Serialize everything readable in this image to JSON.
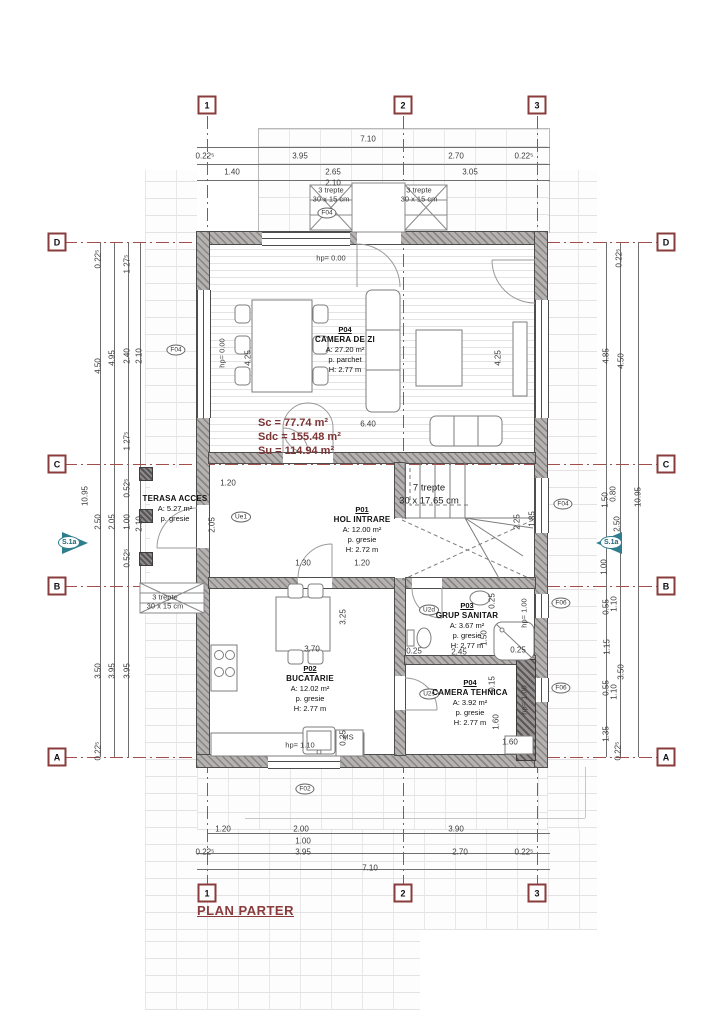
{
  "title": "PLAN PARTER",
  "area_summary": {
    "sc": "Sc = 77.74 m²",
    "sdc": "Sdc = 155.48 m²",
    "su": "Su = 114.94 m²"
  },
  "section_marker": {
    "label": "S.1a"
  },
  "colors": {
    "axis": "#9a4545",
    "section_marker": "#2e7e8e",
    "title": "#8a3b3b",
    "summary": "#7c3434",
    "wall_fill": "#b6b2b2"
  },
  "terasa": {
    "name": "TERASA ACCES",
    "area": "A: 5.27 m²",
    "floor": "p. gresie"
  },
  "rooms": [
    {
      "num": "P04",
      "name": "CAMERA DE ZI",
      "l1": "A: 27.20 m²",
      "l2": "p. parchet",
      "l3": "H: 2.77 m",
      "x": 345,
      "y": 325
    },
    {
      "num": "P01",
      "name": "HOL INTRARE",
      "l1": "A: 12.00 m²",
      "l2": "p. gresie",
      "l3": "H: 2.72 m",
      "x": 362,
      "y": 505
    },
    {
      "num": "P02",
      "name": "BUCATARIE",
      "l1": "A: 12.02 m²",
      "l2": "p. gresie",
      "l3": "H: 2.77 m",
      "x": 310,
      "y": 664
    },
    {
      "num": "P03",
      "name": "GRUP SANITAR",
      "l1": "A: 3.67 m²",
      "l2": "p. gresie",
      "l3": "H: 2.77 m",
      "x": 467,
      "y": 601
    },
    {
      "num": "P04",
      "name": "CAMERA TEHNICA",
      "l1": "A: 3.92 m²",
      "l2": "p. gresie",
      "l3": "H: 2.77 m",
      "x": 470,
      "y": 678
    }
  ],
  "axis_markers": [
    {
      "t": "1",
      "x": 207,
      "y": 105
    },
    {
      "t": "2",
      "x": 403,
      "y": 105
    },
    {
      "t": "3",
      "x": 537,
      "y": 105
    },
    {
      "t": "1",
      "x": 207,
      "y": 893
    },
    {
      "t": "2",
      "x": 403,
      "y": 893
    },
    {
      "t": "3",
      "x": 537,
      "y": 893
    },
    {
      "t": "D",
      "x": 57,
      "y": 242
    },
    {
      "t": "C",
      "x": 57,
      "y": 464
    },
    {
      "t": "B",
      "x": 57,
      "y": 586
    },
    {
      "t": "A",
      "x": 57,
      "y": 757
    },
    {
      "t": "D",
      "x": 666,
      "y": 242
    },
    {
      "t": "C",
      "x": 666,
      "y": 464
    },
    {
      "t": "B",
      "x": 666,
      "y": 586
    },
    {
      "t": "A",
      "x": 666,
      "y": 757
    }
  ],
  "tags": [
    {
      "t": "F04",
      "x": 327,
      "y": 213
    },
    {
      "t": "F04",
      "x": 176,
      "y": 350
    },
    {
      "t": "F04",
      "x": 563,
      "y": 504
    },
    {
      "t": "F06",
      "x": 561,
      "y": 603
    },
    {
      "t": "F06",
      "x": 561,
      "y": 688
    },
    {
      "t": "F02",
      "x": 305,
      "y": 789
    },
    {
      "t": "U2d",
      "x": 429,
      "y": 610
    },
    {
      "t": "U2s",
      "x": 429,
      "y": 694
    },
    {
      "t": "Ue1",
      "x": 241,
      "y": 517
    }
  ],
  "dimension_labels": [
    {
      "t": "7.10",
      "x": 368,
      "y": 139
    },
    {
      "t": "0.22⁵",
      "x": 205,
      "y": 156
    },
    {
      "t": "3.95",
      "x": 300,
      "y": 156
    },
    {
      "t": "2.70",
      "x": 456,
      "y": 156
    },
    {
      "t": "0.22⁵",
      "x": 524,
      "y": 156
    },
    {
      "t": "1.40",
      "x": 232,
      "y": 172
    },
    {
      "t": "2.65",
      "x": 333,
      "y": 172
    },
    {
      "t": "3.05",
      "x": 470,
      "y": 172
    },
    {
      "t": "2.10",
      "x": 333,
      "y": 183
    },
    {
      "t": "1.20",
      "x": 223,
      "y": 829
    },
    {
      "t": "2.00",
      "x": 301,
      "y": 829
    },
    {
      "t": "3.90",
      "x": 456,
      "y": 829
    },
    {
      "t": "1.00",
      "x": 303,
      "y": 841
    },
    {
      "t": "0.22⁵",
      "x": 205,
      "y": 852
    },
    {
      "t": "3.95",
      "x": 303,
      "y": 852
    },
    {
      "t": "2.70",
      "x": 460,
      "y": 852
    },
    {
      "t": "0.22⁵",
      "x": 524,
      "y": 852
    },
    {
      "t": "7.10",
      "x": 370,
      "y": 868
    },
    {
      "t": "0.22⁵",
      "x": 98,
      "y": 259,
      "r": -90
    },
    {
      "t": "1.27⁵",
      "x": 127,
      "y": 264,
      "r": -90
    },
    {
      "t": "4.50",
      "x": 98,
      "y": 366,
      "r": -90
    },
    {
      "t": "4.95",
      "x": 112,
      "y": 358,
      "r": -90
    },
    {
      "t": "2.40",
      "x": 127,
      "y": 356,
      "r": -90
    },
    {
      "t": "2.10",
      "x": 139,
      "y": 356,
      "r": -90
    },
    {
      "t": "1.27⁵",
      "x": 127,
      "y": 441,
      "r": -90
    },
    {
      "t": "10.95",
      "x": 85,
      "y": 496,
      "r": -90
    },
    {
      "t": "2.50",
      "x": 98,
      "y": 522,
      "r": -90
    },
    {
      "t": "2.05",
      "x": 112,
      "y": 522,
      "r": -90
    },
    {
      "t": "0.52⁵",
      "x": 127,
      "y": 488,
      "r": -90
    },
    {
      "t": "1.00",
      "x": 127,
      "y": 522,
      "r": -90
    },
    {
      "t": "2.10",
      "x": 139,
      "y": 524,
      "r": -90
    },
    {
      "t": "0.52⁵",
      "x": 127,
      "y": 558,
      "r": -90
    },
    {
      "t": "3.50",
      "x": 98,
      "y": 671,
      "r": -90
    },
    {
      "t": "3.95",
      "x": 112,
      "y": 671,
      "r": -90
    },
    {
      "t": "3.95",
      "x": 127,
      "y": 671,
      "r": -90
    },
    {
      "t": "0.22⁵",
      "x": 98,
      "y": 751,
      "r": -90
    },
    {
      "t": "0.22⁵",
      "x": 619,
      "y": 258,
      "r": -90
    },
    {
      "t": "4.85",
      "x": 606,
      "y": 356,
      "r": -90
    },
    {
      "t": "4.50",
      "x": 621,
      "y": 361,
      "r": -90
    },
    {
      "t": "10.95",
      "x": 638,
      "y": 497,
      "r": -90
    },
    {
      "t": "1.50",
      "x": 605,
      "y": 500,
      "r": -90
    },
    {
      "t": "0.80",
      "x": 613,
      "y": 494,
      "r": -90
    },
    {
      "t": "2.50",
      "x": 617,
      "y": 524,
      "r": -90
    },
    {
      "t": "1.00",
      "x": 604,
      "y": 567,
      "r": -90
    },
    {
      "t": "0.55",
      "x": 606,
      "y": 607,
      "r": -90
    },
    {
      "t": "1.10",
      "x": 614,
      "y": 604,
      "r": -90
    },
    {
      "t": "1.15",
      "x": 607,
      "y": 647,
      "r": -90
    },
    {
      "t": "3.50",
      "x": 621,
      "y": 672,
      "r": -90
    },
    {
      "t": "0.55",
      "x": 606,
      "y": 688,
      "r": -90
    },
    {
      "t": "1.10",
      "x": 614,
      "y": 692,
      "r": -90
    },
    {
      "t": "1.35",
      "x": 606,
      "y": 734,
      "r": -90
    },
    {
      "t": "0.22⁵",
      "x": 618,
      "y": 751,
      "r": -90
    },
    {
      "t": "6.40",
      "x": 368,
      "y": 424
    },
    {
      "t": "4.25",
      "x": 248,
      "y": 358,
      "r": -90
    },
    {
      "t": "4.25",
      "x": 498,
      "y": 358,
      "r": -90
    },
    {
      "t": "1.20",
      "x": 228,
      "y": 483
    },
    {
      "t": "2.05",
      "x": 212,
      "y": 525,
      "r": -90
    },
    {
      "t": "1.30",
      "x": 303,
      "y": 563
    },
    {
      "t": "1.20",
      "x": 362,
      "y": 563
    },
    {
      "t": "2.25",
      "x": 517,
      "y": 522,
      "r": -90
    },
    {
      "t": "1.85",
      "x": 532,
      "y": 519,
      "r": -90
    },
    {
      "t": "3.70",
      "x": 312,
      "y": 649
    },
    {
      "t": "3.25",
      "x": 343,
      "y": 617,
      "r": -90
    },
    {
      "t": "0.25",
      "x": 343,
      "y": 738,
      "r": -90
    },
    {
      "t": "0.25",
      "x": 414,
      "y": 651
    },
    {
      "t": "2.45",
      "x": 459,
      "y": 652
    },
    {
      "t": "1.50",
      "x": 484,
      "y": 638,
      "r": -90
    },
    {
      "t": "0.25",
      "x": 518,
      "y": 650
    },
    {
      "t": "0.25",
      "x": 492,
      "y": 601,
      "r": -90
    },
    {
      "t": "1.60",
      "x": 496,
      "y": 722,
      "r": -90
    },
    {
      "t": "0.15",
      "x": 492,
      "y": 684,
      "r": -90
    },
    {
      "t": "1.60",
      "x": 510,
      "y": 742
    },
    {
      "t": "hp= 0.00",
      "x": 331,
      "y": 258,
      "c": "n"
    },
    {
      "t": "hp= 0.00",
      "x": 222,
      "y": 353,
      "r": -90,
      "c": "n"
    },
    {
      "t": "hp= 1.10",
      "x": 300,
      "y": 745,
      "c": "n"
    },
    {
      "t": "MS",
      "x": 348,
      "y": 737,
      "c": "n"
    },
    {
      "t": "hp= 1.00",
      "x": 524,
      "y": 613,
      "r": -90,
      "c": "n"
    },
    {
      "t": "hp= 1.00",
      "x": 524,
      "y": 700,
      "r": -90,
      "c": "n"
    },
    {
      "t": "3 trepte",
      "x": 331,
      "y": 190,
      "c": "n"
    },
    {
      "t": "30 x 15 cm",
      "x": 331,
      "y": 199,
      "c": "n"
    },
    {
      "t": "3 trepte",
      "x": 419,
      "y": 190,
      "c": "n"
    },
    {
      "t": "30 x 15 cm",
      "x": 419,
      "y": 199,
      "c": "n"
    },
    {
      "t": "3 trepte",
      "x": 165,
      "y": 597,
      "c": "n"
    },
    {
      "t": "30 x 15 cm",
      "x": 165,
      "y": 606,
      "c": "n"
    },
    {
      "t": "7 trepte",
      "x": 429,
      "y": 488,
      "c": "big"
    },
    {
      "t": "30 x 17.65 cm",
      "x": 429,
      "y": 501,
      "c": "big"
    }
  ]
}
